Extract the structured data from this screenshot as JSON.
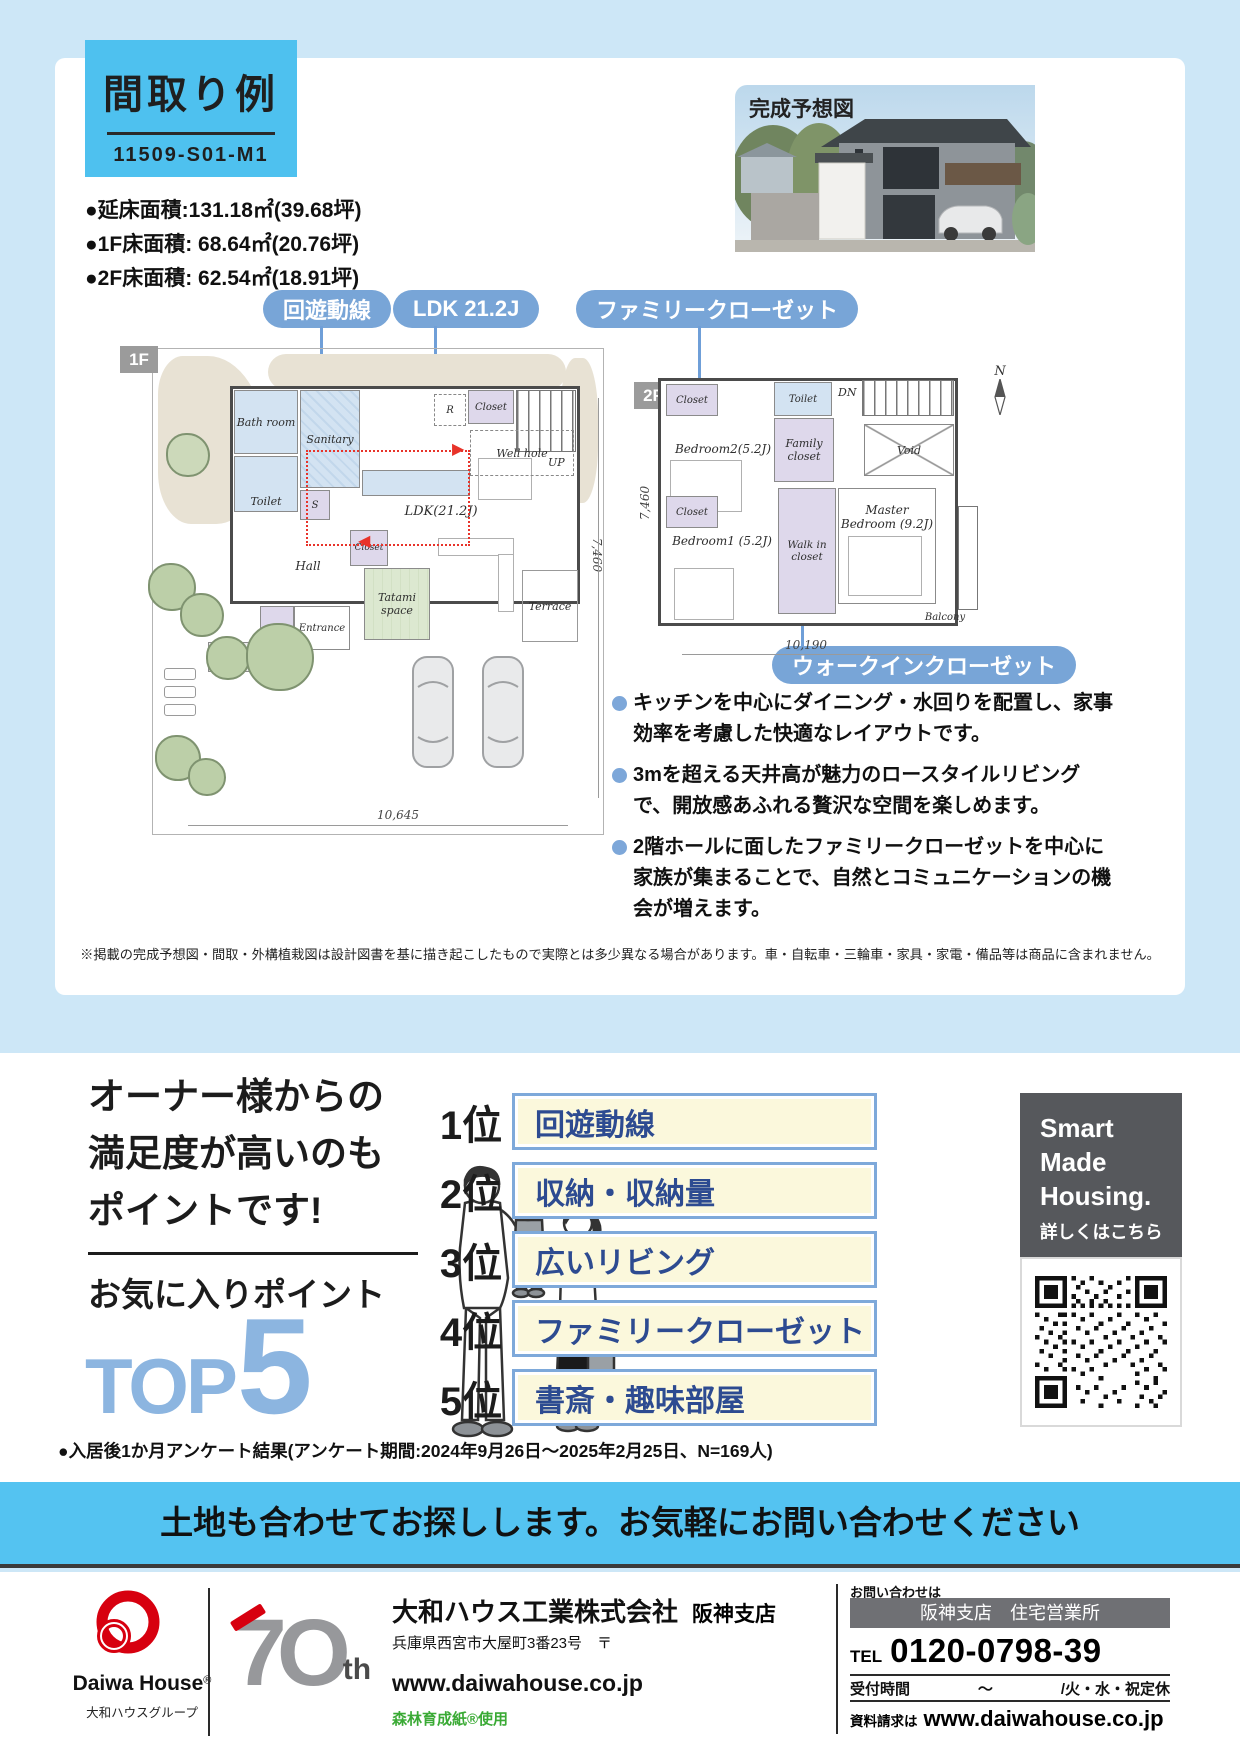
{
  "header": {
    "title": "間取り例",
    "code": "11509-S01-M1"
  },
  "areas": [
    "●延床面積:131.18㎡(39.68坪)",
    "●1F床面積: 68.64㎡(20.76坪)",
    "●2F床面積: 62.54㎡(18.91坪)"
  ],
  "rendering": {
    "caption": "完成予想図"
  },
  "callouts": {
    "circulation": "回遊動線",
    "ldk": "LDK 21.2J",
    "family": "ファミリークローゼット",
    "wic": "ウォークインクローゼット"
  },
  "plan1f": {
    "badge": "1F",
    "rooms": {
      "bath": "Bath room",
      "sanitary": "Sanitary",
      "s": "S",
      "toilet": "Toilet",
      "r": "R",
      "closet_top": "Closet",
      "up": "UP",
      "well": "Well hole",
      "ldk": "LDK(21.2J)",
      "hall": "Hall",
      "closet_hall": "Closet",
      "closet_ent": "Closet",
      "entrance": "Entrance",
      "porch": "Porch",
      "tatami": "Tatami space",
      "terrace": "Terrace"
    },
    "dim_w": "10,645",
    "dim_h": "7,460"
  },
  "plan2f": {
    "badge": "2F",
    "rooms": {
      "closet_a": "Closet",
      "bedroom2": "Bedroom2(5.2J)",
      "toilet": "Toilet",
      "dn": "DN",
      "family": "Family closet",
      "void": "Void",
      "closet_b": "Closet",
      "bedroom1": "Bedroom1 (5.2J)",
      "wic": "Walk in closet",
      "master": "Master Bedroom (9.2J)",
      "balcony": "Balcony"
    },
    "dim_w": "10,190",
    "dim_h": "7,460"
  },
  "compass": "N",
  "features": [
    "キッチンを中心にダイニング・水回りを配置し、家事効率を考慮した快適なレイアウトです。",
    "3mを超える天井高が魅力のロースタイルリビングで、開放感あふれる贅沢な空間を楽しめます。",
    "2階ホールに面したファミリークローゼットを中心に家族が集まることで、自然とコミュニケーションの機会が増えます。"
  ],
  "disclaimer": "※掲載の完成予想図・間取・外構植栽図は設計図書を基に描き起こしたもので実際とは多少異なる場合があります。車・自転車・三輪車・家具・家電・備品等は商品に含まれません。",
  "top5": {
    "heading_lines": [
      "オーナー様からの",
      "満足度が高いのも",
      "ポイントです!"
    ],
    "subheading": "お気に入りポイント",
    "top_word": "TOP",
    "top_number": "5",
    "ranks": [
      {
        "rank": "1位",
        "label": "回遊動線"
      },
      {
        "rank": "2位",
        "label": "収納・収納量"
      },
      {
        "rank": "3位",
        "label": "広いリビング"
      },
      {
        "rank": "4位",
        "label": "ファミリークローゼット"
      },
      {
        "rank": "5位",
        "label": "書斎・趣味部屋"
      }
    ],
    "survey_note": "●入居後1か月アンケート結果(アンケート期間:2024年9月26日〜2025年2月25日、N=169人)"
  },
  "smh": {
    "line1": "Smart",
    "line2": "Made",
    "line3": "Housing.",
    "cta": "詳しくはこちら"
  },
  "banner": "土地も合わせてお探しします。お気軽にお問い合わせください",
  "footer": {
    "logo_name": "Daiwa House",
    "logo_reg": "®",
    "logo_group": "大和ハウスグループ",
    "anniv_7": "7",
    "anniv_0": "O",
    "anniv_th": "th",
    "company": "大和ハウス工業株式会社",
    "branch": "阪神支店",
    "address": "兵庫県西宮市大屋町3番23号　〒",
    "url": "www.daiwahouse.co.jp",
    "paper": "森林育成紙®使用",
    "contact": {
      "heading": "お問い合わせは",
      "office": "阪神支店　住宅営業所",
      "tel_label": "TEL",
      "tel": "0120-0798-39",
      "hours_label": "受付時間",
      "hours_tilde": "〜",
      "hours_closed": "/火・水・祝定休",
      "request_label": "資料請求は",
      "request_url": "www.daiwahouse.co.jp"
    }
  }
}
